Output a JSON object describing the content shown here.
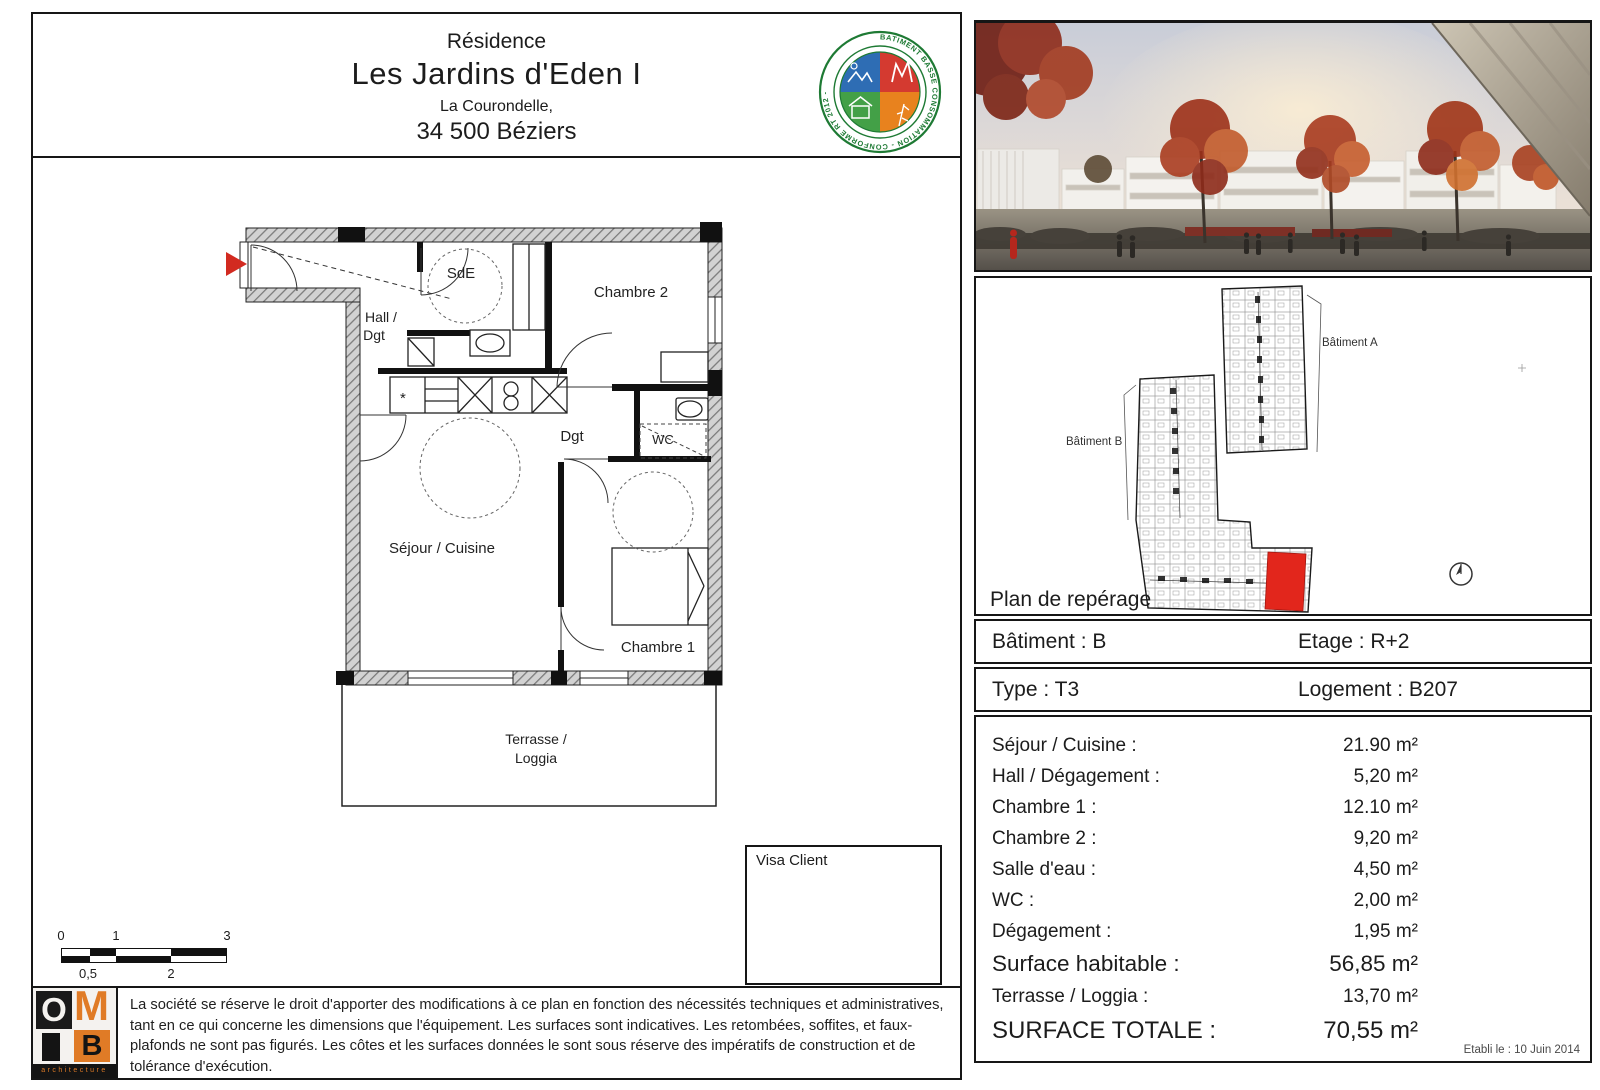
{
  "header": {
    "line1": "Résidence",
    "title": "Les Jardins d'Eden I",
    "line3": "La Courondelle,",
    "line4": "34 500 Béziers"
  },
  "eco_label": {
    "ring_text": "BATIMENT BASSE CONSOMMATION - CONFORME RT 2012 - ",
    "colors": {
      "ring": "#1e7a34",
      "top_left": "#2e6db4",
      "top_right": "#d43a30",
      "bottom_left": "#43a047",
      "bottom_right": "#e8821e"
    }
  },
  "floor_plan": {
    "labels": {
      "sde": "SdE",
      "chambre2": "Chambre 2",
      "hall1": "Hall /",
      "hall2": "Dgt",
      "dgt": "Dgt",
      "wc": "WC",
      "sejour": "Séjour / Cuisine",
      "chambre1": "Chambre 1",
      "terrasse1": "Terrasse /",
      "terrasse2": "Loggia"
    },
    "entry_arrow_color": "#d22a20"
  },
  "scale_bar": {
    "top": [
      "0",
      "1",
      "3"
    ],
    "bottom": [
      "0,5",
      "2"
    ]
  },
  "visa": {
    "label": "Visa Client"
  },
  "disclaimer": {
    "text": "La société se réserve le droit d'apporter des modifications à ce plan en fonction des nécessités techniques et administratives, tant en ce qui concerne les dimensions que l'équipement. Les surfaces sont indicatives. Les retombées, soffites, et faux-plafonds ne sont pas figurés. Les côtes et les surfaces données le sont sous réserve des impératifs de construction et de tolérance d'exécution.",
    "logo": {
      "o": "O",
      "m": "M",
      "b": "B",
      "caption": "architecture"
    }
  },
  "site_plan": {
    "title": "Plan de repérage",
    "building_a": "Bâtiment A",
    "building_b": "Bâtiment B",
    "highlight_color": "#e2261c"
  },
  "unit_info": {
    "batiment": "Bâtiment : B",
    "etage": "Etage : R+2",
    "type": "Type : T3",
    "logement": "Logement : B207"
  },
  "surfaces": {
    "rows": [
      {
        "label": "Séjour / Cuisine :",
        "value": "21.90 m²"
      },
      {
        "label": "Hall / Dégagement :",
        "value": "5,20 m²"
      },
      {
        "label": "Chambre 1 :",
        "value": "12.10 m²"
      },
      {
        "label": "Chambre 2 :",
        "value": "9,20 m²"
      },
      {
        "label": "Salle d'eau :",
        "value": "4,50 m²"
      },
      {
        "label": "WC :",
        "value": "2,00 m²"
      },
      {
        "label": "Dégagement :",
        "value": "1,95 m²"
      },
      {
        "label": "Surface habitable :",
        "value": "56,85 m²"
      },
      {
        "label": "Terrasse / Loggia :",
        "value": "13,70 m²"
      },
      {
        "label": "SURFACE TOTALE :",
        "value": "70,55 m²"
      }
    ],
    "date_note": "Etabli le : 10 Juin 2014"
  }
}
